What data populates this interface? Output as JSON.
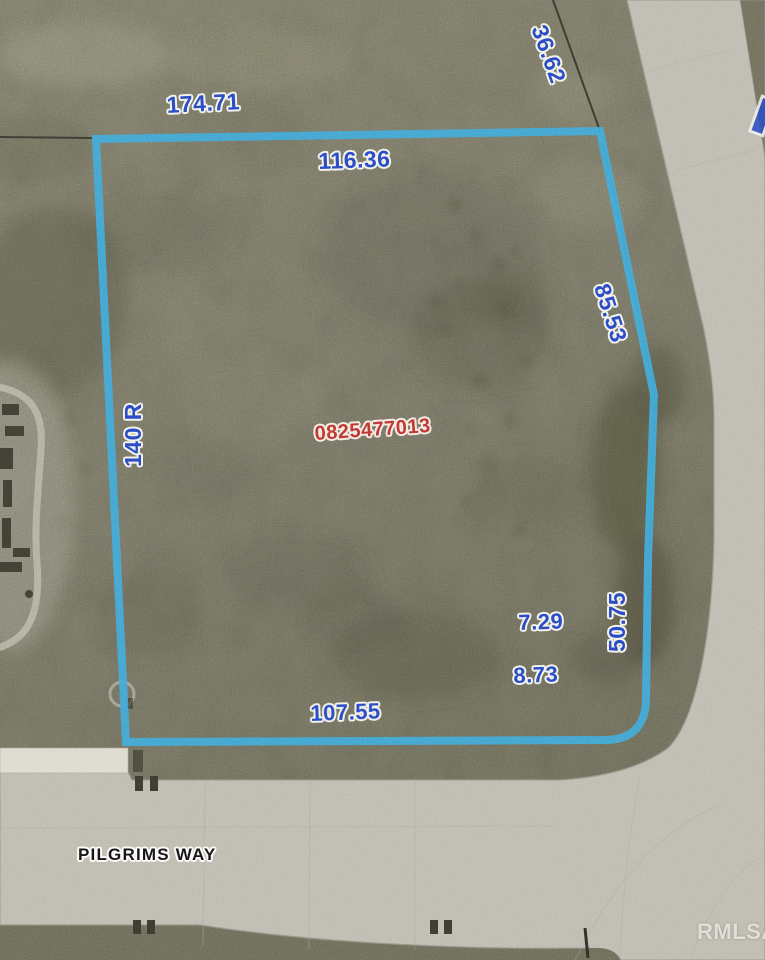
{
  "map": {
    "title": "plat-map-aerial",
    "parcel_id": {
      "text": "0825477013"
    },
    "street": {
      "name": "PILGRIMS WAY"
    },
    "watermark": {
      "text": "RMLSA"
    },
    "dimensions": {
      "top_outer": "174.71",
      "top_inner": "116.36",
      "ne_diagonal": "36.62",
      "right_upper": "85.53",
      "left": "140 R",
      "right_lower": "50.75",
      "corner_seg_1": "7.29",
      "corner_seg_2": "8.73",
      "bottom": "107.55"
    },
    "colors": {
      "boundary_blue": "#3fa7d8",
      "dimension_text_blue": "#2b4ec6",
      "parcel_id_red": "#c23a32",
      "road_gray": "#bdbaaf",
      "sidewalk": "#dcd9cd",
      "grass_olive": "#7b7967",
      "street_text": "#17171a",
      "watermark_white": "#f0eee6"
    }
  }
}
